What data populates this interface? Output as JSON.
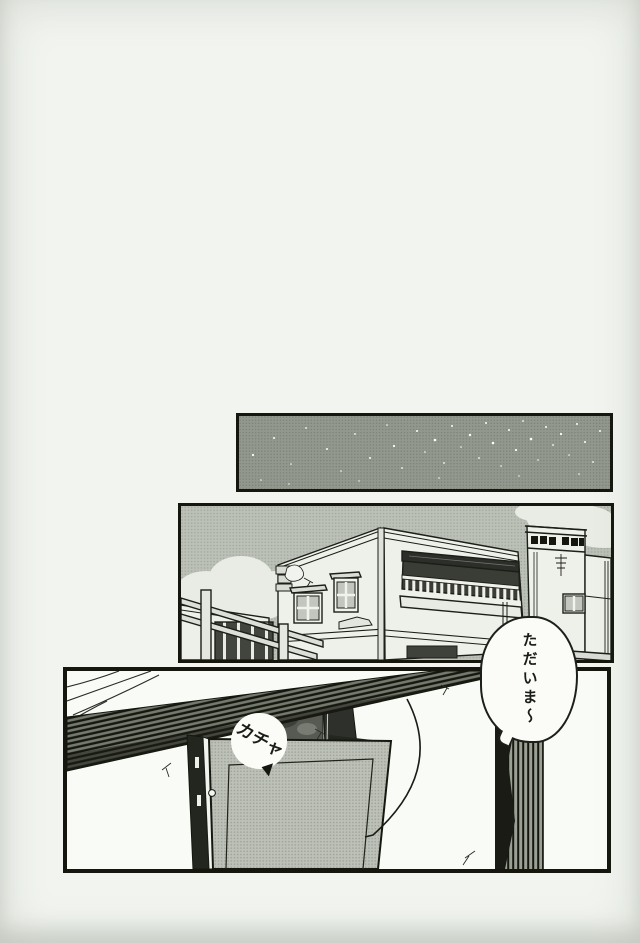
{
  "speech_bubble": {
    "text": "ただいま〜"
  },
  "sfx": {
    "text": "カチャ"
  },
  "colors": {
    "paper": "#f1f4ef",
    "ink": "#1a1c17",
    "night_sky": "#93988f",
    "day_sky": "#b9beb5",
    "house_wall": "#eef0ea",
    "door_tone": "#b7bbb2",
    "cloud": "#e9ece4"
  }
}
